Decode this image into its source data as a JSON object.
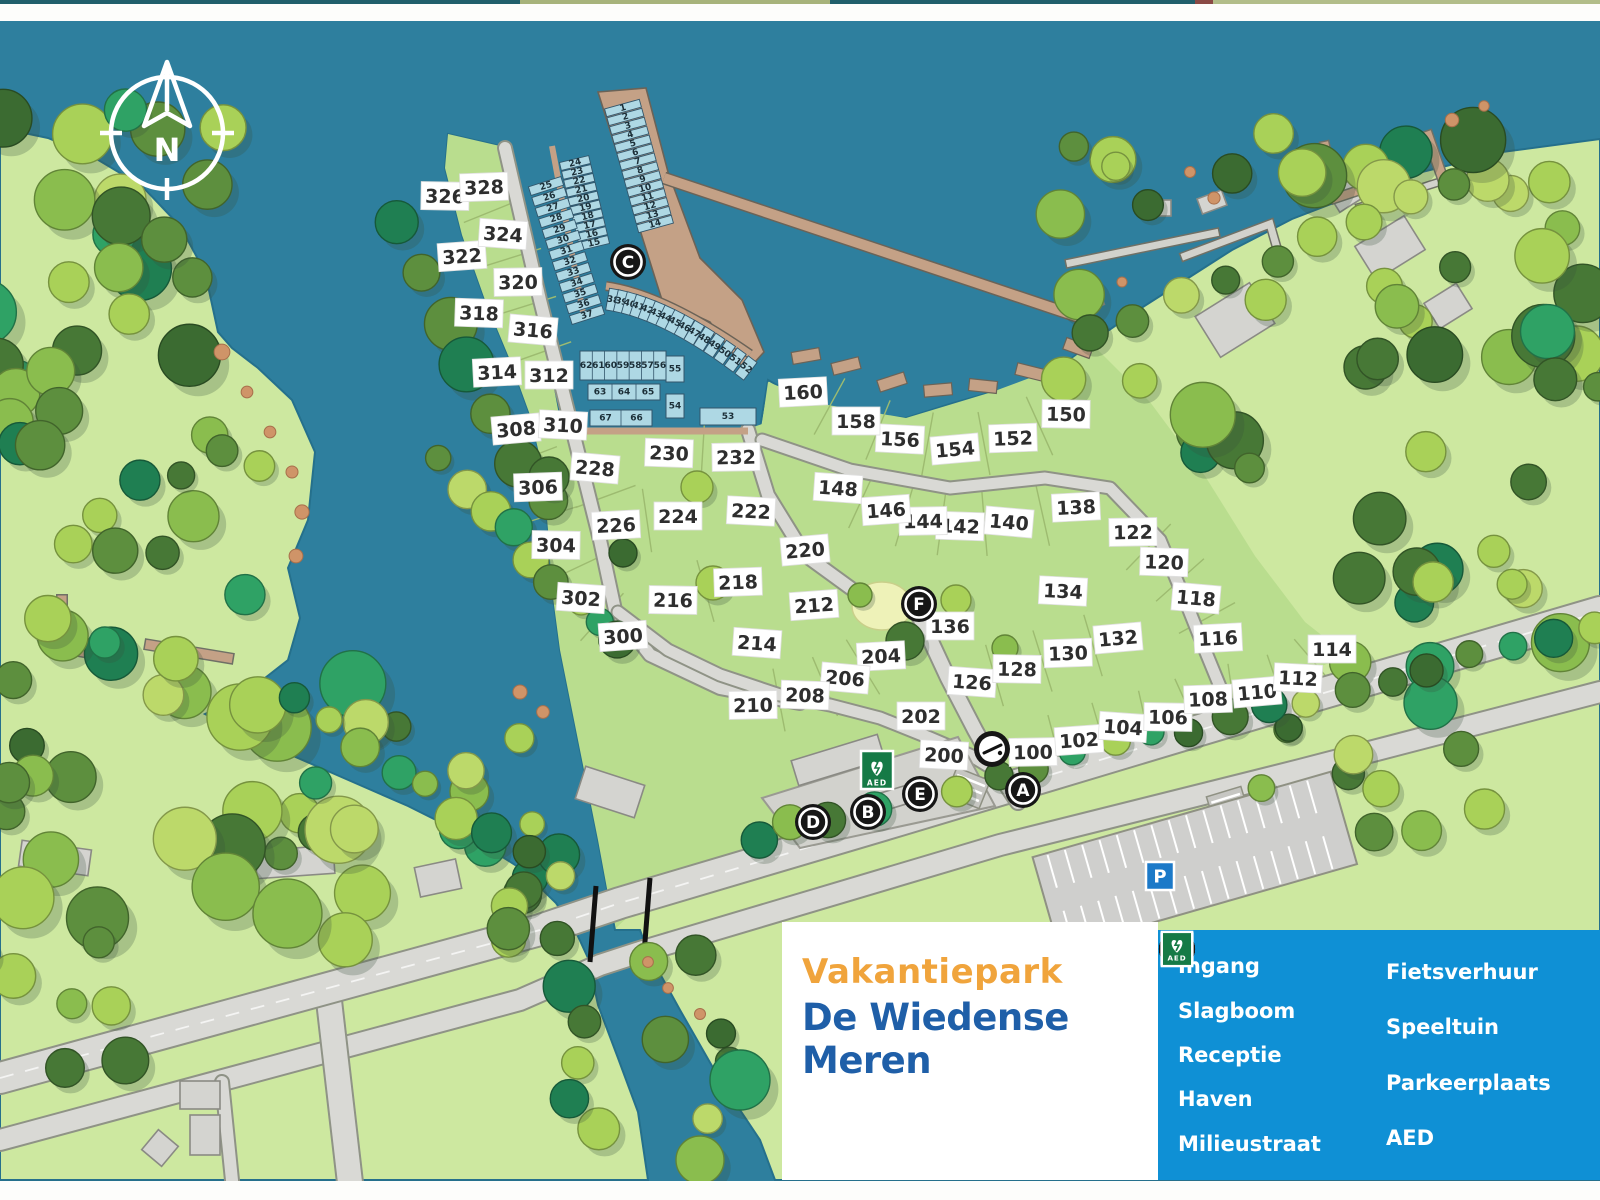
{
  "title": {
    "line1": "Vakantiepark",
    "line2": "De Wiedense Meren"
  },
  "compass": {
    "label": "N"
  },
  "legend": {
    "columns": [
      [
        {
          "icon": "A",
          "label": "Ingang"
        },
        {
          "icon": "slagboom",
          "label": "Slagboom"
        },
        {
          "icon": "B",
          "label": "Receptie"
        },
        {
          "icon": "C",
          "label": "Haven"
        },
        {
          "icon": "D",
          "label": "Milieustraat"
        }
      ],
      [
        {
          "icon": "E",
          "label": "Fietsverhuur"
        },
        {
          "icon": "F",
          "label": "Speeltuin"
        },
        {
          "icon": "P",
          "label": "Parkeerplaats"
        },
        {
          "icon": "AED",
          "label": "AED"
        }
      ]
    ]
  },
  "map": {
    "markers": [
      {
        "id": "C",
        "x": 628,
        "y": 262
      },
      {
        "id": "F",
        "x": 919,
        "y": 604
      },
      {
        "id": "E",
        "x": 920,
        "y": 794
      },
      {
        "id": "B",
        "x": 868,
        "y": 812
      },
      {
        "id": "D",
        "x": 813,
        "y": 822
      },
      {
        "id": "A",
        "x": 1023,
        "y": 790
      },
      {
        "id": "slagboom",
        "x": 992,
        "y": 749
      }
    ],
    "signs": [
      {
        "id": "aed",
        "label": "AED",
        "x": 877,
        "y": 770
      },
      {
        "id": "p",
        "label": "P",
        "x": 1160,
        "y": 876
      }
    ],
    "plots": [
      [
        100,
        1033,
        752
      ],
      [
        102,
        1079,
        740
      ],
      [
        104,
        1123,
        727
      ],
      [
        106,
        1168,
        717
      ],
      [
        108,
        1208,
        699
      ],
      [
        110,
        1257,
        692
      ],
      [
        112,
        1298,
        678
      ],
      [
        114,
        1332,
        649
      ],
      [
        116,
        1218,
        638
      ],
      [
        118,
        1196,
        598
      ],
      [
        120,
        1164,
        562
      ],
      [
        122,
        1133,
        532
      ],
      [
        126,
        972,
        682
      ],
      [
        128,
        1017,
        669
      ],
      [
        130,
        1068,
        653
      ],
      [
        132,
        1118,
        638
      ],
      [
        134,
        1063,
        591
      ],
      [
        136,
        950,
        626
      ],
      [
        138,
        1076,
        507
      ],
      [
        140,
        1009,
        522
      ],
      [
        142,
        960,
        526
      ],
      [
        144,
        923,
        521
      ],
      [
        146,
        886,
        510
      ],
      [
        148,
        838,
        488
      ],
      [
        150,
        1066,
        414
      ],
      [
        152,
        1013,
        438
      ],
      [
        154,
        955,
        449
      ],
      [
        156,
        900,
        439
      ],
      [
        158,
        856,
        421
      ],
      [
        160,
        803,
        392
      ],
      [
        200,
        944,
        755
      ],
      [
        202,
        921,
        716
      ],
      [
        204,
        881,
        656
      ],
      [
        206,
        845,
        678
      ],
      [
        208,
        805,
        695
      ],
      [
        210,
        753,
        705
      ],
      [
        212,
        814,
        605
      ],
      [
        214,
        757,
        643
      ],
      [
        216,
        673,
        600
      ],
      [
        218,
        738,
        582
      ],
      [
        220,
        805,
        550
      ],
      [
        222,
        751,
        511
      ],
      [
        224,
        678,
        516
      ],
      [
        226,
        616,
        525
      ],
      [
        228,
        595,
        468
      ],
      [
        230,
        669,
        453
      ],
      [
        232,
        736,
        457
      ],
      [
        300,
        623,
        636
      ],
      [
        302,
        581,
        598
      ],
      [
        304,
        556,
        545
      ],
      [
        306,
        538,
        487
      ],
      [
        308,
        516,
        429
      ],
      [
        310,
        563,
        425
      ],
      [
        312,
        549,
        375
      ],
      [
        314,
        497,
        372
      ],
      [
        316,
        533,
        330
      ],
      [
        318,
        479,
        313
      ],
      [
        320,
        518,
        282
      ],
      [
        322,
        462,
        256
      ],
      [
        324,
        503,
        234
      ],
      [
        326,
        445,
        196
      ],
      [
        328,
        484,
        187
      ]
    ],
    "marina": {
      "columns": [
        {
          "numbers": [
            1,
            2,
            3,
            4,
            5,
            6,
            7,
            8,
            9,
            10,
            11,
            12,
            13,
            14
          ],
          "from": [
            623,
            108
          ],
          "to": [
            655,
            224
          ],
          "w": 36,
          "h": 8
        },
        {
          "numbers": [
            24,
            23,
            22,
            21,
            20,
            19,
            18,
            17,
            16,
            15
          ],
          "from": [
            575,
            163
          ],
          "to": [
            594,
            243
          ],
          "w": 30,
          "h": 8
        },
        {
          "numbers": [
            25,
            26,
            27,
            28,
            29,
            30,
            31,
            32,
            33,
            34,
            35,
            36,
            37
          ],
          "from": [
            546,
            186
          ],
          "to": [
            587,
            315
          ],
          "w": 34,
          "h": 9
        }
      ],
      "arc": {
        "numbers": [
          38,
          39,
          40,
          41,
          42,
          43,
          44,
          45,
          46,
          47,
          48,
          49,
          50,
          51,
          52
        ],
        "from": [
          613,
          300
        ],
        "ctrl": [
          670,
          310
        ],
        "to": [
          746,
          368
        ],
        "w": 11,
        "h": 22
      },
      "boxes": [
        {
          "numbers": [
            62,
            61,
            60,
            59,
            58,
            57,
            56
          ],
          "x": 580,
          "y": 351,
          "w": 86,
          "h": 29
        },
        {
          "numbers": [
            63,
            64,
            65
          ],
          "x": 588,
          "y": 384,
          "w": 72,
          "h": 16
        },
        {
          "numbers": [
            67,
            66
          ],
          "x": 590,
          "y": 410,
          "w": 62,
          "h": 16
        },
        {
          "numbers": [
            55
          ],
          "x": 666,
          "y": 356,
          "w": 18,
          "h": 26
        },
        {
          "numbers": [
            54
          ],
          "x": 666,
          "y": 394,
          "w": 18,
          "h": 24
        },
        {
          "numbers": [
            53
          ],
          "x": 700,
          "y": 408,
          "w": 56,
          "h": 17
        }
      ]
    }
  },
  "colors": {
    "water": "#2e7f9e",
    "land_light": "#cde8a0",
    "park_green": "#b9dd8e",
    "legend_bg": "#0f90d5",
    "title_orange": "#f0a43c",
    "title_blue": "#1f5fa8",
    "marker": "#161616",
    "berth": "#aed8e4",
    "dock": "#c4a186",
    "road": "#d9d9d5"
  }
}
